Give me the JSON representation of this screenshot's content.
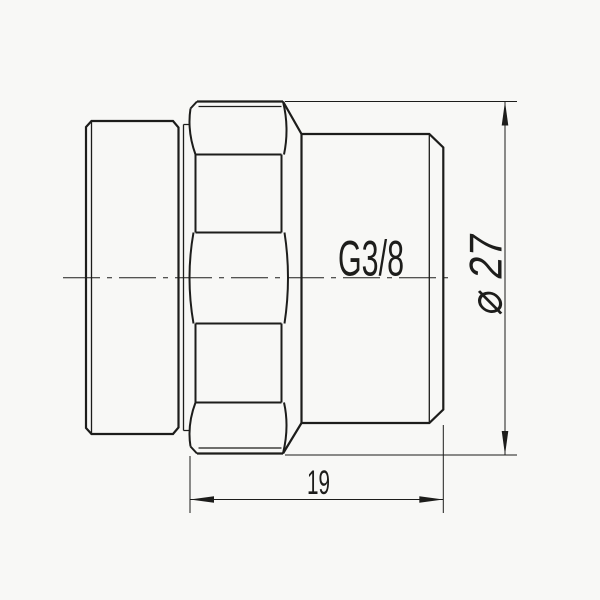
{
  "drawing": {
    "labels": {
      "thread": "G3/8",
      "diameter": "⌀ 27",
      "length": "19"
    },
    "dimensions": {
      "diameter_value": "27",
      "length_value": "19",
      "thread_spec": "G3/8"
    },
    "colors": {
      "line": "#1d1d1b",
      "background": "#f8f8f6"
    }
  }
}
